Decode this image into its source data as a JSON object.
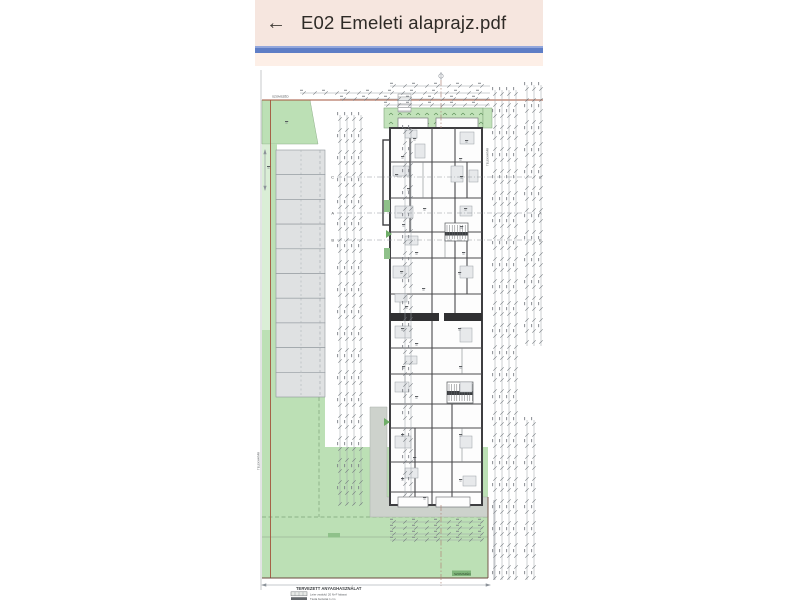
{
  "app": {
    "back_icon": "←",
    "title": "E02 Emeleti alaprajz.pdf"
  },
  "colors": {
    "appbar_bg": "#f6e6df",
    "progress_blue": "#5f7ec6",
    "strip_bg": "#fdefe7",
    "site_green": "#bce0b5",
    "terrace_green": "#c3e3bb",
    "parking_gray": "#dfe1e2",
    "path_gray": "#cdd2cc",
    "wall_dark": "#3e3e41",
    "boundary_red": "#a3543c",
    "dim_gray": "#8d939a",
    "chip_green": "#83b87e"
  },
  "plan": {
    "section_markers_left": [
      "C",
      "A",
      "B"
    ],
    "section_markers_right": [
      "C",
      "A",
      "B"
    ],
    "labels": {
      "top_boundary": "SZOMSZÉD",
      "bottom_chip": "SZOMSZÉD",
      "left_vertical": "TELEKHATÁR",
      "right_vertical": "TELEKHATÁR"
    },
    "parking": {
      "stall_count": 10
    },
    "legend": {
      "heading": "TERVEZETT ANYAGHASZNÁLAT",
      "items": [
        {
          "label": "Leier zsalukő 20 N+F falazat"
        },
        {
          "label": "Tégla burkolat 1 cm"
        }
      ]
    }
  }
}
